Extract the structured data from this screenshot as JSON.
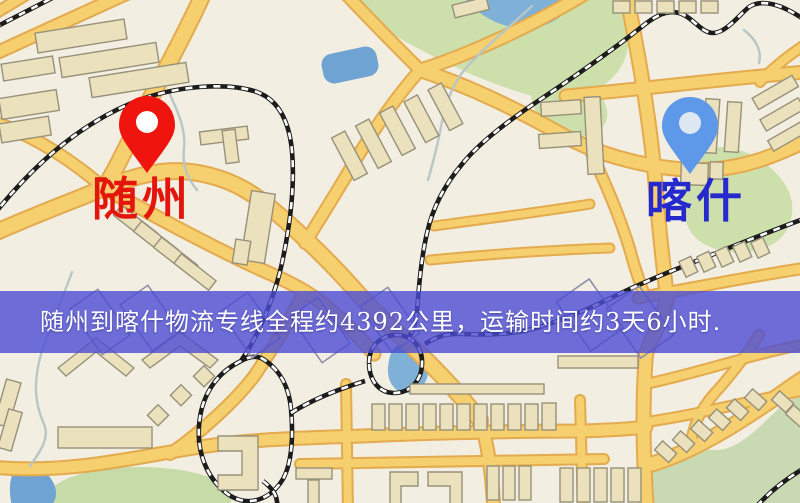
{
  "banner": {
    "text": "随州到喀什物流专线全程约4392公里，运输时间约3天6小时."
  },
  "markers": {
    "origin": {
      "label": "随州",
      "icon": "map-pin-icon"
    },
    "destination": {
      "label": "喀什",
      "icon": "map-pin-icon"
    }
  },
  "colors": {
    "pin-origin": "#f0140e",
    "pin-dest": "#5e98e8",
    "origin-text": "#e3150c",
    "dest-text": "#2629cb",
    "banner-bg": "rgba(76,76,213,0.80)",
    "banner-text": "#ffffff",
    "road-core": "#f6cf6e",
    "road-case": "#e3aa4e",
    "park": "#cddfab",
    "water": "#7fb0d8",
    "rail": "#1c1c1c",
    "bldg": "#ebe1bd",
    "bldg-line": "#97917a",
    "stream": "#b8c6c6"
  }
}
